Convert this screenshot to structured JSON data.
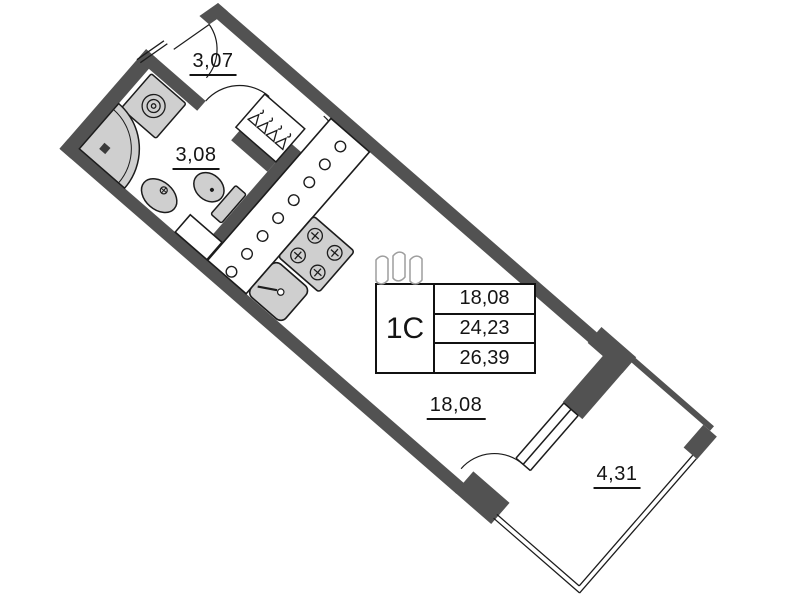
{
  "plan": {
    "unit_type": "1С",
    "rooms": [
      {
        "id": "hallway",
        "area": "3,07"
      },
      {
        "id": "bathroom",
        "area": "3,08"
      },
      {
        "id": "living-room",
        "area": "18,08"
      },
      {
        "id": "balcony",
        "area": "4,31"
      }
    ],
    "info_table": {
      "unit_type": "1С",
      "living_area": "18,08",
      "apartment_area": "24,23",
      "total_area": "26,39"
    },
    "fixtures": [
      "washing-machine",
      "shower",
      "bathroom-sink",
      "toilet",
      "wardrobe-hangers",
      "kitchen-counter",
      "stove",
      "kitchen-sink",
      "ventilation-shaft"
    ],
    "colors": {
      "wall": "#525252",
      "fixture_fill": "#cfcfcf",
      "line": "#1c1c1c",
      "logo_stroke": "#9e9e9e"
    }
  }
}
